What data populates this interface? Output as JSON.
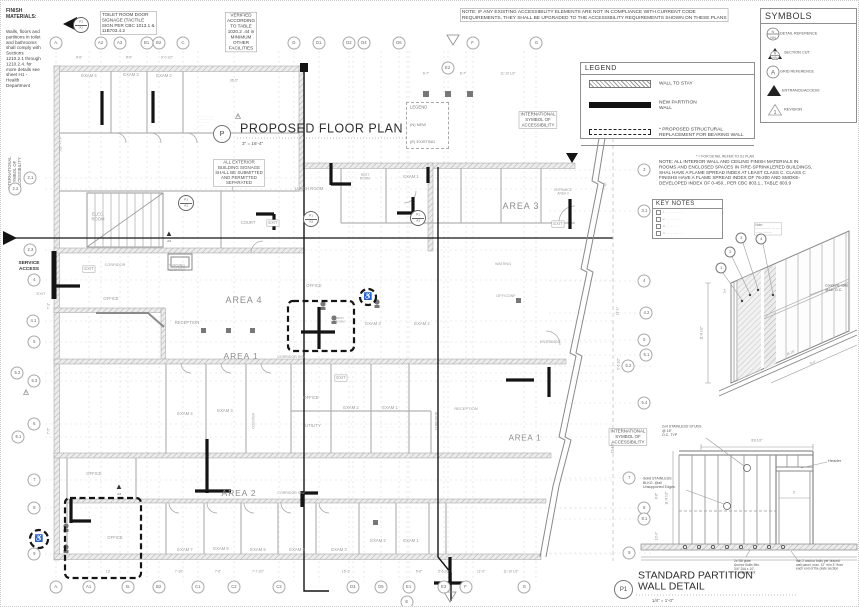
{
  "colors": {
    "paper": "#ffffff",
    "drawing_line": "#9a9a9a",
    "new_wall": "#141414",
    "label_gray": "#9a9a9a",
    "note_text": "#444444"
  },
  "titles": {
    "plan": {
      "bubble": "P",
      "label": "PROPOSED FLOOR PLAN",
      "scale": "3\" = 16'-4\""
    },
    "detail": {
      "bubble": "P1",
      "label": "STANDARD PARTITION\nWALL DETAIL",
      "scale": "1/4\" = 1'-0\""
    }
  },
  "boxes": {
    "symbols": {
      "title": "SYMBOLS",
      "rows": [
        {
          "icon": "detail-reference",
          "glyph_top": "N",
          "glyph_bottom": "NN",
          "label": "DETAIL REFERENCE"
        },
        {
          "icon": "section-cut",
          "glyph_top": "N",
          "glyph_bottom": "NN",
          "label": "SECTION CUT"
        },
        {
          "icon": "grid-reference",
          "glyph": "A",
          "label": "GRID REFERENCE"
        },
        {
          "icon": "entrance-access",
          "label": "ENTRANCE/ACCESS"
        },
        {
          "icon": "revision",
          "glyph": "1",
          "label": "REVISION"
        }
      ]
    },
    "legend": {
      "title": "LEGEND",
      "rows": [
        {
          "swatch": "hatch",
          "label": "WALL TO STAY"
        },
        {
          "swatch": "solid",
          "label": "NEW PARTITION\nWALL"
        },
        {
          "swatch": "dash",
          "label": "* PROPOSED STRUCTURAL\nREPLACEMENT FOR BEARING WALL"
        }
      ],
      "footnote": "* = FOR DETAIL REFER TO S1 PLAN"
    },
    "mini_legend": {
      "title": "LEGEND",
      "items": [
        "(N) NEW",
        "(E) EXISTING"
      ]
    },
    "key_notes": {
      "title": "KEY NOTES",
      "items": [
        {
          "n": "1",
          "t": "·· ········ ······ ···"
        },
        {
          "n": "2",
          "t": "···· ······· ·····"
        },
        {
          "n": "3",
          "t": "······· ···· ··"
        },
        {
          "n": "4",
          "t": "········ ······ · ···"
        }
      ]
    }
  },
  "notes": {
    "finish_materials_title": {
      "t": "FINISH\nMATERIALS:",
      "x": 5,
      "y": 13,
      "s": 5,
      "al": "l",
      "bold": 1,
      "c": "#333"
    },
    "finish_materials_body": {
      "t": "Walls, floors and\npartitions in toilet\nand bathrooms\nshall comply with\nSections\n1210.2.1 through\n1210.2.4. for\nmore details see\nsheet H1 -\nHealth\nDepartment",
      "x": 5,
      "y": 58,
      "s": 4.6,
      "al": "l",
      "c": "#444"
    },
    "toilet_signage": {
      "t": "TOILET ROOM DOOR\nSIGNAGE (TACTILE\nSIGN PER CBC 1013.1 &\n11B703.4.2",
      "x": 99,
      "y": 22,
      "s": 4.6,
      "al": "l",
      "b": 1,
      "c": "#444"
    },
    "verified_table": {
      "t": "VERIFIED\nACCORDING\nTO TABLE\n1020.2 .44 in\nMINIMUM\nOTHER\nFACILITIES",
      "x": 240,
      "y": 31,
      "s": 4.6,
      "b": 1,
      "c": "#444"
    },
    "compliance": {
      "t": "NOTE: IF ANY EXISTING ACCESSIBILITY ELEMENTS ARE NOT IN COMPLIANCE WITH CURRENT CODE\nREQUIREMENTS, THEY SHALL BE UPGRADED TO THE ACCESSIBILITY REQUIREMENTS SHOWN ON THESE PLANS",
      "x": 459,
      "y": 14,
      "s": 4.8,
      "al": "l",
      "b": 1,
      "c": "#444"
    },
    "interior_finish": {
      "t": "NOTE: ALL INTERIOR WALL AND CEILING FINISH MATERIALS IN\nROOMS AND ENCLOSED SPACES IN FIRE-SPRINKLERED BUILDINGS,\nSHAL HAVE A FLAME SPREAD INDEX AT LEAST CLASS C. CLASS C\nFINISHS HAVE A FLAME SPREAD INDEX OF 76-200 AND SMOKE-\nDEVELOPED INDEX OF 0-450., PER CBC 803.1., TABLE 803.9",
      "x": 658,
      "y": 172,
      "s": 4.6,
      "al": "l",
      "c": "#444"
    },
    "exterior_signage": {
      "t": "ALL EXTERIOR\nBUILDING SIGNAGE\nSHALL BE SUBMITTED\nAND PERMITTED\nSEPARATED",
      "x": 238,
      "y": 172,
      "s": 4.4,
      "b": 1,
      "c": "#555"
    },
    "isa_top": {
      "t": "INTERNATIONAL\nSYMBOL OF\nACCESSIBILITY",
      "x": 537,
      "y": 119,
      "s": 4.4,
      "b": 1,
      "c": "#555"
    },
    "isa_right": {
      "t": "INTERNATIONAL\nSYMBOL OF\nACCESSIBILITY",
      "x": 627,
      "y": 436,
      "s": 4.4,
      "b": 1,
      "c": "#555"
    },
    "isa_left": {
      "t": "INTERNATIONAL\nSYMBOL OF\nACCESSIBILITY",
      "x": 14,
      "y": 172,
      "s": 4.2,
      "r": -90,
      "c": "#666"
    },
    "title_side_micro": {
      "t": "···· ··· ·······\n····· ······ ····\n··· ········\n·······",
      "x": 198,
      "y": 120,
      "s": 2.6,
      "al": "l",
      "c": "#aaa"
    },
    "axon_note": {
      "t": "Note:\n··············· ··· ····\n······ ·········",
      "x": 753,
      "y": 228,
      "s": 3.2,
      "al": "l",
      "b": 1,
      "c": "#777"
    }
  },
  "grid": {
    "top": [
      {
        "l": "A.",
        "x": 55
      },
      {
        "l": "A2",
        "x": 100
      },
      {
        "l": "A3",
        "x": 119
      },
      {
        "l": "B1",
        "x": 146
      },
      {
        "l": "B2",
        "x": 158
      },
      {
        "l": "C.",
        "x": 182
      },
      {
        "l": "D.",
        "x": 293
      },
      {
        "l": "D1.",
        "x": 318
      },
      {
        "l": "D2",
        "x": 348
      },
      {
        "l": "D4",
        "x": 363
      },
      {
        "l": "D6",
        "x": 398
      },
      {
        "l": "E2",
        "x": 447,
        "y": 67
      },
      {
        "l": "F",
        "x": 472
      },
      {
        "l": "G",
        "x": 535
      }
    ],
    "bottom": [
      {
        "l": "A.",
        "x": 55
      },
      {
        "l": "A1",
        "x": 88
      },
      {
        "l": "B.",
        "x": 127
      },
      {
        "l": "B2",
        "x": 158
      },
      {
        "l": "C1.",
        "x": 197
      },
      {
        "l": "C2",
        "x": 233
      },
      {
        "l": "C3",
        "x": 278
      },
      {
        "l": "D3.",
        "x": 352
      },
      {
        "l": "D5",
        "x": 380
      },
      {
        "l": "E1",
        "x": 408
      },
      {
        "l": "E",
        "x": 406,
        "y": 601
      },
      {
        "l": "E3",
        "x": 443
      },
      {
        "l": "F",
        "x": 465
      },
      {
        "l": "G",
        "x": 523
      }
    ],
    "left": [
      {
        "l": "2.1",
        "x": 29,
        "y": 177
      },
      {
        "l": "2.2",
        "x": 14,
        "y": 188
      },
      {
        "l": "2.3",
        "x": 29,
        "y": 249
      },
      {
        "l": "4",
        "x": 33,
        "y": 279
      },
      {
        "l": "4.1",
        "x": 32,
        "y": 320
      },
      {
        "l": "5",
        "x": 33,
        "y": 341
      },
      {
        "l": "5.2",
        "x": 16,
        "y": 372
      },
      {
        "l": "5.3",
        "x": 33,
        "y": 380
      },
      {
        "l": "6",
        "x": 33,
        "y": 423
      },
      {
        "l": "6.1",
        "x": 17,
        "y": 436
      },
      {
        "l": "7",
        "x": 33,
        "y": 479
      },
      {
        "l": "8",
        "x": 33,
        "y": 507
      },
      {
        "l": "9",
        "x": 33,
        "y": 553
      }
    ],
    "right": [
      {
        "l": "3",
        "x": 643,
        "y": 169
      },
      {
        "l": "3.1",
        "x": 643,
        "y": 210
      },
      {
        "l": "4",
        "x": 643,
        "y": 280
      },
      {
        "l": "4.2",
        "x": 645,
        "y": 312
      },
      {
        "l": "5",
        "x": 643,
        "y": 339
      },
      {
        "l": "5.1",
        "x": 645,
        "y": 354
      },
      {
        "l": "5.2",
        "x": 627,
        "y": 365
      },
      {
        "l": "5.4",
        "x": 643,
        "y": 402
      },
      {
        "l": "7",
        "x": 628,
        "y": 477
      },
      {
        "l": "8",
        "x": 643,
        "y": 507
      },
      {
        "l": "8.1",
        "x": 643,
        "y": 518
      },
      {
        "l": "9",
        "x": 628,
        "y": 552
      }
    ]
  },
  "plan_labels": [
    {
      "t": "EXAM 4",
      "x": 88,
      "y": 75
    },
    {
      "t": "EXAM 3",
      "x": 130,
      "y": 74
    },
    {
      "t": "EXAM 2",
      "x": 163,
      "y": 75
    },
    {
      "t": "ELEC.\nROOM",
      "x": 97,
      "y": 216
    },
    {
      "t": "LUNCH ROOM",
      "x": 308,
      "y": 188
    },
    {
      "t": "COURT",
      "x": 247,
      "y": 222
    },
    {
      "t": "EXIT",
      "x": 272,
      "y": 222,
      "b": 1
    },
    {
      "t": "REST\nROOM",
      "x": 364,
      "y": 176,
      "s": 3.2
    },
    {
      "t": "EXAM 1",
      "x": 410,
      "y": 176
    },
    {
      "t": "AREA 3",
      "x": 520,
      "y": 206,
      "s": 9,
      "ls": 1,
      "c": "#8d8d8d"
    },
    {
      "t": "ENTRANCE\nAREA 3",
      "x": 562,
      "y": 191,
      "s": 3.2
    },
    {
      "t": "EXIT",
      "x": 557,
      "y": 223,
      "b": 1
    },
    {
      "t": "SERVICE\nACCESS",
      "x": 28,
      "y": 265,
      "s": 4.8,
      "bold": 1,
      "c": "#333"
    },
    {
      "t": "EXIT",
      "x": 40,
      "y": 293,
      "s": 4
    },
    {
      "t": "EXIT",
      "x": 88,
      "y": 268,
      "b": 1
    },
    {
      "t": "CORRIDOR",
      "x": 114,
      "y": 264,
      "s": 3.8
    },
    {
      "t": "NURSING\nCOUNTER",
      "x": 176,
      "y": 267,
      "s": 3.4
    },
    {
      "t": "OFFICE",
      "x": 110,
      "y": 298
    },
    {
      "t": "RECEPTION",
      "x": 186,
      "y": 322
    },
    {
      "t": "AREA 4",
      "x": 243,
      "y": 300,
      "s": 9,
      "ls": 1,
      "c": "#8d8d8d"
    },
    {
      "t": "OFFICE",
      "x": 313,
      "y": 285
    },
    {
      "t": "REST\nROOM",
      "x": 339,
      "y": 319,
      "s": 3
    },
    {
      "t": "EXAM 3",
      "x": 372,
      "y": 323
    },
    {
      "t": "EXAM 2",
      "x": 421,
      "y": 323
    },
    {
      "t": "OFF/CONF",
      "x": 505,
      "y": 295,
      "s": 3.8
    },
    {
      "t": "WAITING",
      "x": 502,
      "y": 263,
      "s": 3.8
    },
    {
      "t": "ENTRANCE",
      "x": 549,
      "y": 341,
      "s": 3.6
    },
    {
      "t": "AREA 1",
      "x": 240,
      "y": 356,
      "s": 8.5,
      "ls": 1,
      "c": "#8d8d8d"
    },
    {
      "t": "CORRIDOR S/W",
      "x": 290,
      "y": 356,
      "s": 3.6
    },
    {
      "t": "EXIT",
      "x": 340,
      "y": 377,
      "b": 1
    },
    {
      "t": "OFFICE",
      "x": 310,
      "y": 397
    },
    {
      "t": "EXAM 2",
      "x": 350,
      "y": 407
    },
    {
      "t": "EXAM 1",
      "x": 389,
      "y": 407
    },
    {
      "t": "UTILITY",
      "x": 312,
      "y": 425
    },
    {
      "t": "EXAM 4",
      "x": 184,
      "y": 413
    },
    {
      "t": "EXAM 3",
      "x": 224,
      "y": 410
    },
    {
      "t": "COUNTER",
      "x": 253,
      "y": 420,
      "r": -90,
      "s": 3.2
    },
    {
      "t": "CORRIDOR",
      "x": 436,
      "y": 420,
      "r": -90,
      "s": 3.4
    },
    {
      "t": "AREA 1",
      "x": 524,
      "y": 438,
      "s": 8,
      "ls": 1,
      "c": "#8d8d8d"
    },
    {
      "t": "RECEPTION",
      "x": 465,
      "y": 408,
      "s": 4
    },
    {
      "t": "AREA 2",
      "x": 238,
      "y": 493,
      "s": 8.5,
      "ls": 1,
      "c": "#8d8d8d"
    },
    {
      "t": "CORRIDOR S/W",
      "x": 290,
      "y": 492,
      "s": 3.6
    },
    {
      "t": "OFFICE",
      "x": 93,
      "y": 473
    },
    {
      "t": "OFFICE",
      "x": 114,
      "y": 537
    },
    {
      "t": "EXAM 7",
      "x": 184,
      "y": 549
    },
    {
      "t": "EXAM 6",
      "x": 220,
      "y": 548
    },
    {
      "t": "EXAM 5",
      "x": 257,
      "y": 549
    },
    {
      "t": "EXAM 4",
      "x": 296,
      "y": 549
    },
    {
      "t": "EXAM 3",
      "x": 338,
      "y": 549
    },
    {
      "t": "EXAM 2",
      "x": 377,
      "y": 540
    },
    {
      "t": "EXAM 1",
      "x": 410,
      "y": 540
    },
    {
      "t": "♿",
      "x": 367,
      "y": 296,
      "s": 7,
      "c": "#333"
    },
    {
      "t": "♿",
      "x": 38,
      "y": 538,
      "s": 7,
      "c": "#333"
    },
    {
      "t": "··· ··· ·····\n···· ·· ······",
      "x": 184,
      "y": 426,
      "s": 2.2,
      "c": "#b0b0b0"
    },
    {
      "t": "··· ··· ·····\n···· ·· ······",
      "x": 389,
      "y": 428,
      "s": 2.2,
      "c": "#b0b0b0"
    }
  ],
  "dims": [
    {
      "t": "9'-6\"",
      "x": 78,
      "y": 57
    },
    {
      "t": "9'-9\"",
      "x": 128,
      "y": 57
    },
    {
      "t": "9'-0 1/2\"",
      "x": 166,
      "y": 57
    },
    {
      "t": "36'-5\"",
      "x": 233,
      "y": 80
    },
    {
      "t": "6'-7\"",
      "x": 425,
      "y": 73
    },
    {
      "t": "6'-7\"",
      "x": 462,
      "y": 73
    },
    {
      "t": "11'-10 1/2\"",
      "x": 507,
      "y": 73
    },
    {
      "t": "13'",
      "x": 107,
      "y": 571
    },
    {
      "t": "7'-10\"",
      "x": 178,
      "y": 571
    },
    {
      "t": "7'-6\"",
      "x": 217,
      "y": 571
    },
    {
      "t": "7'-7 1/2\"",
      "x": 257,
      "y": 571
    },
    {
      "t": "15'-1\"",
      "x": 345,
      "y": 571
    },
    {
      "t": "5'-6\"",
      "x": 418,
      "y": 571
    },
    {
      "t": "5'-6 1/2\"",
      "x": 443,
      "y": 571
    },
    {
      "t": "11'-0\"",
      "x": 480,
      "y": 571
    },
    {
      "t": "11'-10 1/2\"",
      "x": 510,
      "y": 571
    },
    {
      "t": "7'-11\"",
      "x": 604,
      "y": 185,
      "r": -72
    },
    {
      "t": "11'-1\"",
      "x": 617,
      "y": 310,
      "r": -90
    },
    {
      "t": "5'-6 1/2\"",
      "x": 618,
      "y": 363,
      "r": -90
    },
    {
      "t": "21'-1/2\"",
      "x": 612,
      "y": 447,
      "r": -90
    },
    {
      "t": "8'-6\"",
      "x": 656,
      "y": 495,
      "r": -90
    },
    {
      "t": "10'-9\"",
      "x": 656,
      "y": 535,
      "r": -90
    },
    {
      "t": "7'-1\"",
      "x": 48,
      "y": 305,
      "r": -90
    },
    {
      "t": "7'-5\"",
      "x": 48,
      "y": 430,
      "r": -90
    },
    {
      "t": "3/16\" = 1'-0\"",
      "x": 60,
      "y": 143,
      "r": -90,
      "s": 2.8
    },
    {
      "t": "11'-8 1/2\"",
      "x": 701,
      "y": 332,
      "r": -90
    },
    {
      "t": "@ 16\"",
      "x": 790,
      "y": 352,
      "r": -24
    },
    {
      "t": "9'-0\"",
      "x": 812,
      "y": 362,
      "r": -24
    },
    {
      "t": "2x4",
      "x": 724,
      "y": 290,
      "r": -90,
      "s": 2.6
    },
    {
      "t": "8'8 1/2\"",
      "x": 756,
      "y": 440,
      "s": 3.4
    },
    {
      "t": "11'-8 1/2\"",
      "x": 666,
      "y": 497,
      "r": -90
    },
    {
      "t": "3'",
      "x": 793,
      "y": 492,
      "s": 3.4
    }
  ],
  "annotations": [
    {
      "t": "Concrete nails\n@16\" O.C.",
      "x": 824,
      "y": 287
    },
    {
      "t": "2x4 STAINLESS STUDS\n@ 16\"\nO.C. TYP",
      "x": 661,
      "y": 430
    },
    {
      "t": "Header",
      "x": 827,
      "y": 460,
      "s": 4
    },
    {
      "t": "Solid STAINLESS\nBLKG. @all\nUnsupported Edges",
      "x": 642,
      "y": 482
    },
    {
      "t": "2x Sill plate\nAnchor Bolts Min.\n3/4\" DIA x 10\",\n7\" embedment",
      "x": 733,
      "y": 566,
      "s": 3.3
    },
    {
      "t": "min 2 anchor bolts per braced\nwall panel, max. 12\" min 4\" from\neach end of the plate section",
      "x": 795,
      "y": 564,
      "s": 3.3
    }
  ],
  "callouts": [
    {
      "n": "1",
      "x": 720,
      "y": 267
    },
    {
      "n": "2",
      "x": 729,
      "y": 251
    },
    {
      "n": "3",
      "x": 740,
      "y": 237
    },
    {
      "n": "4",
      "x": 760,
      "y": 238
    }
  ],
  "detail_markers": [
    {
      "a": "P1",
      "b": "A3",
      "x": 310,
      "y": 218
    },
    {
      "a": "P1",
      "b": "A3",
      "x": 417,
      "y": 217
    },
    {
      "a": "P1",
      "b": "A1",
      "x": 185,
      "y": 202
    },
    {
      "a": "P1",
      "b": "A1",
      "x": 80,
      "y": 24
    }
  ],
  "revision_markers": [
    {
      "n": "1",
      "x": 237,
      "y": 114
    },
    {
      "n": "1",
      "x": 25,
      "y": 390
    }
  ],
  "a3_markers": [
    {
      "t": "A3",
      "x": 118,
      "y": 486
    },
    {
      "t": "A3",
      "x": 168,
      "y": 233
    }
  ]
}
